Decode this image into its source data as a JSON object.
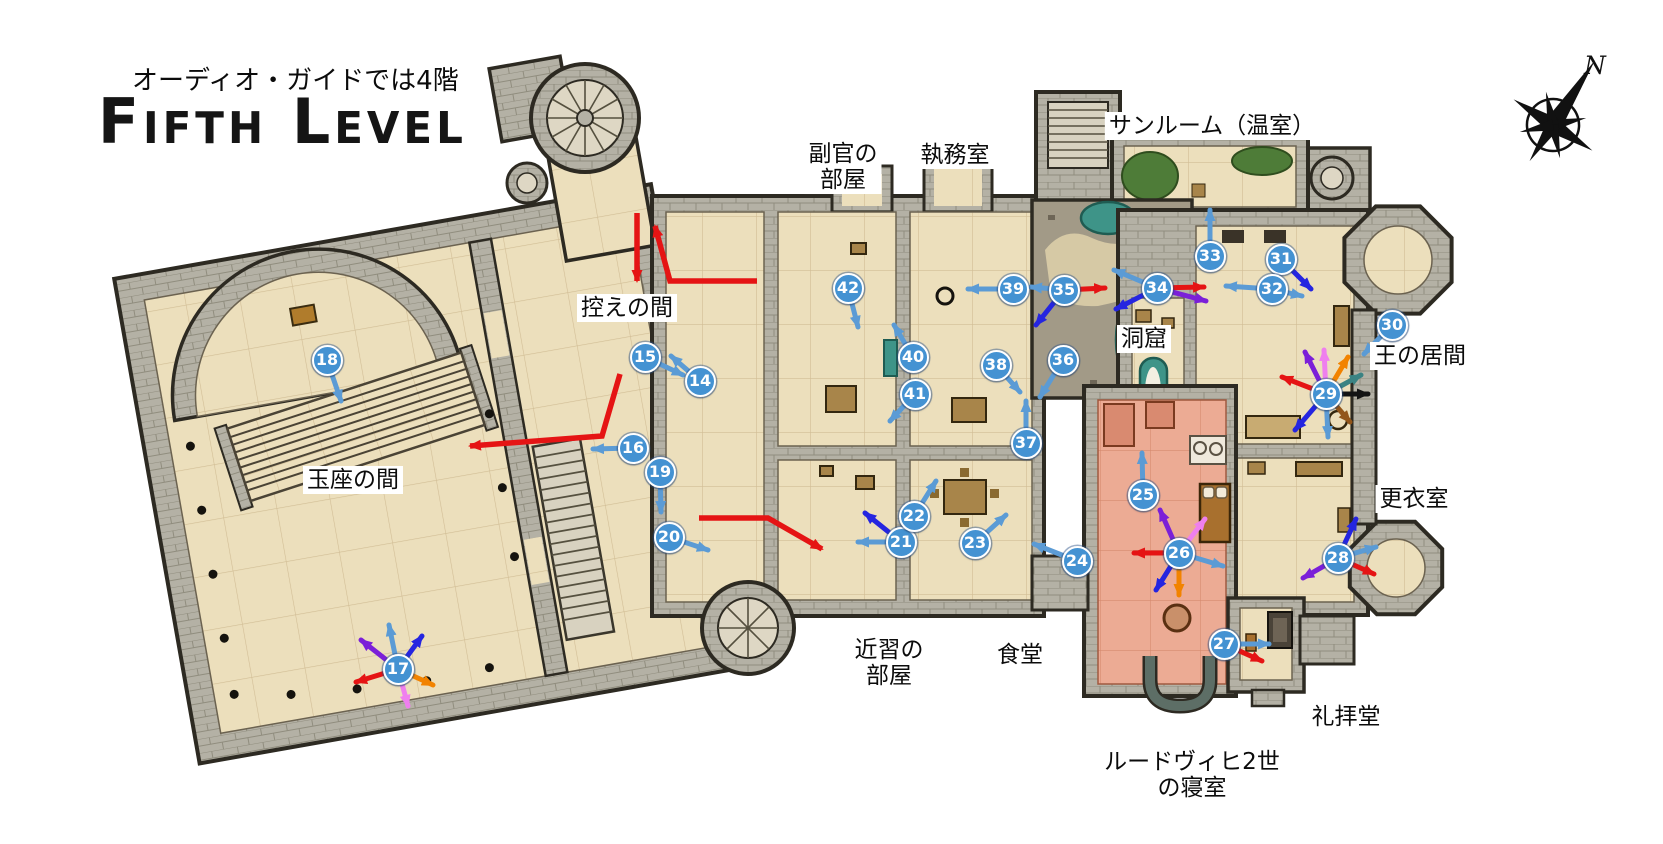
{
  "title": {
    "subtitle_jp": "オーディオ・ガイドでは4階",
    "main": "Fifth Level"
  },
  "compass": {
    "label": "N"
  },
  "colors": {
    "marker_fill": "#4492d2",
    "lightblue": "#5b9bd5",
    "blue": "#2525e0",
    "purple": "#7b1fd8",
    "pink": "#ef7fee",
    "orange": "#f28300",
    "red": "#e51414",
    "teal": "#3b8383",
    "black": "#141414",
    "brown": "#92551a"
  },
  "room_labels": [
    {
      "id": "sunroom",
      "text": "サンルーム（温室）",
      "x": 1212,
      "y": 126
    },
    {
      "id": "adjutant-room",
      "text": "副官の\n部屋",
      "x": 843,
      "y": 167
    },
    {
      "id": "study",
      "text": "執務室",
      "x": 955,
      "y": 155
    },
    {
      "id": "anteroom",
      "text": "控えの間",
      "x": 627,
      "y": 308
    },
    {
      "id": "grotto",
      "text": "洞窟",
      "x": 1144,
      "y": 339
    },
    {
      "id": "kings-living-room",
      "text": "王の居間",
      "x": 1420,
      "y": 356
    },
    {
      "id": "throne-hall",
      "text": "玉座の間",
      "x": 353,
      "y": 480
    },
    {
      "id": "dressing-room",
      "text": "更衣室",
      "x": 1414,
      "y": 499
    },
    {
      "id": "servants-room",
      "text": "近習の\n部屋",
      "x": 889,
      "y": 663
    },
    {
      "id": "dining-room",
      "text": "食堂",
      "x": 1020,
      "y": 655
    },
    {
      "id": "ludwig-bedroom",
      "text": "ルードヴィヒ2世\nの寝室",
      "x": 1192,
      "y": 775
    },
    {
      "id": "chapel",
      "text": "礼拝堂",
      "x": 1346,
      "y": 717
    }
  ],
  "markers": [
    {
      "n": "14",
      "x": 700,
      "y": 381,
      "arrows": [
        [
          "lightblue",
          -29,
          -25
        ]
      ]
    },
    {
      "n": "15",
      "x": 645,
      "y": 357,
      "arrows": [
        [
          "lightblue",
          38,
          18
        ]
      ]
    },
    {
      "n": "16",
      "x": 633,
      "y": 448,
      "arrows": [
        [
          "lightblue",
          -40,
          1
        ]
      ]
    },
    {
      "n": "17",
      "x": 398,
      "y": 669,
      "arrows": [
        [
          "lightblue",
          -9,
          -44
        ],
        [
          "blue",
          24,
          -33
        ],
        [
          "purple",
          -37,
          -29
        ],
        [
          "red",
          -42,
          13
        ],
        [
          "orange",
          35,
          16
        ],
        [
          "pink",
          10,
          37
        ]
      ]
    },
    {
      "n": "18",
      "x": 327,
      "y": 360,
      "arrows": [
        [
          "lightblue",
          14,
          41
        ]
      ]
    },
    {
      "n": "19",
      "x": 660,
      "y": 472,
      "arrows": [
        [
          "lightblue",
          1,
          40
        ]
      ]
    },
    {
      "n": "20",
      "x": 669,
      "y": 537,
      "arrows": [
        [
          "lightblue",
          39,
          13
        ]
      ]
    },
    {
      "n": "21",
      "x": 901,
      "y": 542,
      "arrows": [
        [
          "blue",
          -36,
          -29
        ],
        [
          "lightblue",
          -43,
          0
        ]
      ]
    },
    {
      "n": "22",
      "x": 914,
      "y": 516,
      "arrows": [
        [
          "lightblue",
          22,
          -35
        ]
      ]
    },
    {
      "n": "23",
      "x": 975,
      "y": 543,
      "arrows": [
        [
          "lightblue",
          31,
          -28
        ]
      ]
    },
    {
      "n": "24",
      "x": 1077,
      "y": 561,
      "arrows": [
        [
          "lightblue",
          -43,
          -17
        ]
      ]
    },
    {
      "n": "25",
      "x": 1143,
      "y": 495,
      "arrows": [
        [
          "lightblue",
          -1,
          -42
        ]
      ]
    },
    {
      "n": "26",
      "x": 1179,
      "y": 553,
      "arrows": [
        [
          "purple",
          -19,
          -43
        ],
        [
          "pink",
          26,
          -34
        ],
        [
          "red",
          -45,
          0
        ],
        [
          "lightblue",
          44,
          13
        ],
        [
          "blue",
          -23,
          37
        ],
        [
          "orange",
          0,
          42
        ]
      ]
    },
    {
      "n": "27",
      "x": 1224,
      "y": 644,
      "arrows": [
        [
          "lightblue",
          45,
          0
        ],
        [
          "red",
          38,
          17
        ]
      ]
    },
    {
      "n": "28",
      "x": 1338,
      "y": 558,
      "arrows": [
        [
          "blue",
          18,
          -39
        ],
        [
          "lightblue",
          38,
          -11
        ],
        [
          "red",
          36,
          16
        ],
        [
          "purple",
          -35,
          20
        ]
      ]
    },
    {
      "n": "29",
      "x": 1326,
      "y": 394,
      "arrows": [
        [
          "red",
          -44,
          -17
        ],
        [
          "purple",
          -21,
          -42
        ],
        [
          "pink",
          -2,
          -44
        ],
        [
          "orange",
          22,
          -37
        ],
        [
          "teal",
          35,
          -19
        ],
        [
          "black",
          42,
          0
        ],
        [
          "brown",
          24,
          28
        ],
        [
          "lightblue",
          2,
          43
        ],
        [
          "blue",
          -31,
          36
        ]
      ]
    },
    {
      "n": "30",
      "x": 1392,
      "y": 325,
      "arrows": [
        [
          "lightblue",
          -28,
          29
        ]
      ]
    },
    {
      "n": "31",
      "x": 1281,
      "y": 259,
      "arrows": [
        [
          "blue",
          30,
          30
        ]
      ]
    },
    {
      "n": "32",
      "x": 1272,
      "y": 289,
      "arrows": [
        [
          "lightblue",
          -46,
          -3
        ],
        [
          "lightblue",
          30,
          7
        ]
      ]
    },
    {
      "n": "33",
      "x": 1210,
      "y": 256,
      "arrows": [
        [
          "lightblue",
          0,
          -46
        ]
      ]
    },
    {
      "n": "34",
      "x": 1157,
      "y": 288,
      "arrows": [
        [
          "lightblue",
          -43,
          -18
        ],
        [
          "blue",
          -41,
          21
        ],
        [
          "red",
          47,
          -1
        ],
        [
          "purple",
          49,
          13
        ]
      ]
    },
    {
      "n": "35",
      "x": 1064,
      "y": 290,
      "arrows": [
        [
          "lightblue",
          -33,
          -3
        ],
        [
          "red",
          41,
          -2
        ],
        [
          "blue",
          -28,
          35
        ]
      ]
    },
    {
      "n": "36",
      "x": 1063,
      "y": 360,
      "arrows": [
        [
          "lightblue",
          -23,
          37
        ]
      ]
    },
    {
      "n": "37",
      "x": 1026,
      "y": 443,
      "arrows": [
        [
          "lightblue",
          0,
          -42
        ]
      ]
    },
    {
      "n": "38",
      "x": 996,
      "y": 365,
      "arrows": [
        [
          "lightblue",
          24,
          27
        ]
      ]
    },
    {
      "n": "39",
      "x": 1013,
      "y": 289,
      "arrows": [
        [
          "lightblue",
          -45,
          0
        ]
      ]
    },
    {
      "n": "40",
      "x": 913,
      "y": 357,
      "arrows": [
        [
          "lightblue",
          -19,
          -32
        ]
      ]
    },
    {
      "n": "41",
      "x": 915,
      "y": 394,
      "arrows": [
        [
          "lightblue",
          -25,
          27
        ]
      ]
    },
    {
      "n": "42",
      "x": 848,
      "y": 288,
      "arrows": [
        [
          "lightblue",
          10,
          39
        ]
      ]
    }
  ],
  "route_arrows": [
    {
      "points": [
        [
          637,
          213
        ],
        [
          637,
          281
        ]
      ],
      "head": true
    },
    {
      "points": [
        [
          757,
          281
        ],
        [
          670,
          281
        ],
        [
          655,
          226
        ]
      ],
      "head": true
    },
    {
      "points": [
        [
          620,
          374
        ],
        [
          602,
          436
        ],
        [
          470,
          446
        ]
      ],
      "head": true
    },
    {
      "points": [
        [
          699,
          518
        ],
        [
          768,
          518
        ],
        [
          822,
          549
        ]
      ],
      "head": true
    }
  ]
}
